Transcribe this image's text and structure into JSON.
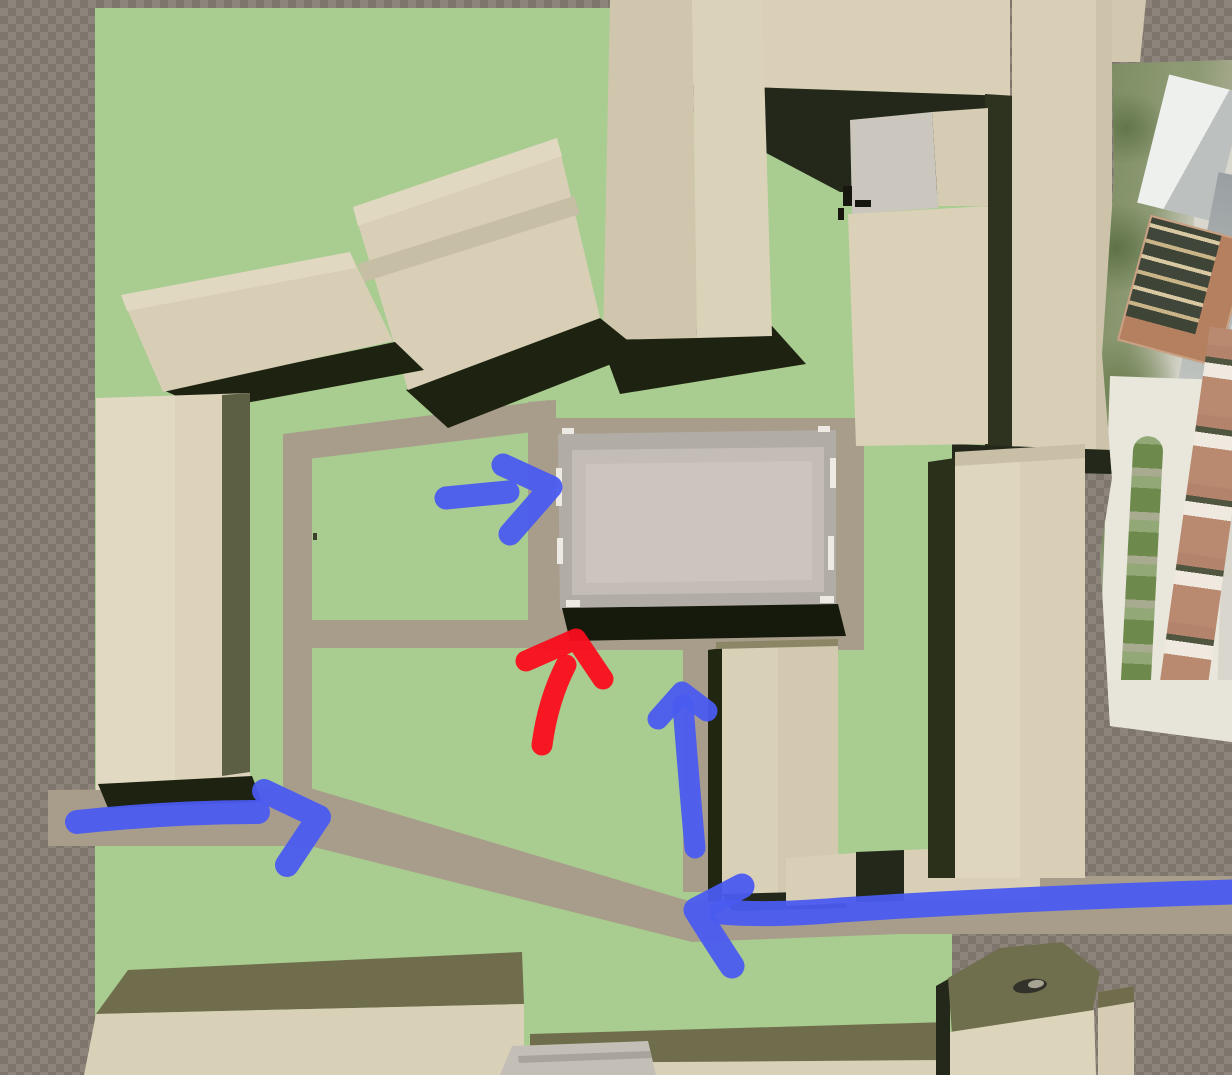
{
  "viewport": {
    "width": 1232,
    "height": 1075,
    "kind": "3d-site-model-top-down-view"
  },
  "palette": {
    "ground_green": "#a9cc90",
    "path_tan": "#a89d8b",
    "building_cream": "#dbd2b9",
    "building_roof_olive": "#6f6d4c",
    "shadow_dark": "#1d2310",
    "central_building_gray": "#c9c3bb",
    "annotation_blue": "#4a5bf0",
    "annotation_red": "#fa0d1d",
    "checker_light": "#8d847b",
    "checker_dark": "#7e756d"
  },
  "scene": {
    "shapes": [
      {
        "type": "polygon",
        "name": "ground-green-lawn",
        "attrs": {
          "points": "95,8 612,8 612,88 990,88 990,448 952,448 952,1040 690,1040 690,1075 95,1075",
          "fill": "#a9cc90"
        }
      },
      {
        "type": "polygon",
        "name": "path-loop-top",
        "attrs": {
          "points": "283,434 550,400 550,430 283,462",
          "fill": "#a89d8b"
        }
      },
      {
        "type": "polygon",
        "name": "path-loop-left",
        "attrs": {
          "points": "283,434 312,434 312,812 283,812",
          "fill": "#a89d8b"
        }
      },
      {
        "type": "polygon",
        "name": "path-loop-right",
        "attrs": {
          "points": "528,402 556,400 556,625 528,625",
          "fill": "#a89d8b"
        }
      },
      {
        "type": "polygon",
        "name": "path-courtyard-middle",
        "attrs": {
          "points": "295,620 558,620 558,648 295,648",
          "fill": "#a89d8b"
        }
      },
      {
        "type": "polygon",
        "name": "path-plaza-pad",
        "attrs": {
          "points": "546,418 864,418 864,650 546,650",
          "fill": "#a89d8b"
        }
      },
      {
        "type": "polygon",
        "name": "path-vertical-south",
        "attrs": {
          "points": "683,645 713,645 713,892 683,892",
          "fill": "#a89d8b"
        }
      },
      {
        "type": "polygon",
        "name": "path-diagonal-west",
        "attrs": {
          "points": "48,790 310,788 692,902 692,942 310,846 48,846",
          "fill": "#a89d8b"
        }
      },
      {
        "type": "polygon",
        "name": "path-east-road",
        "attrs": {
          "points": "692,902 900,876 1232,876 1232,934 900,934 692,942",
          "fill": "#a89d8b"
        }
      },
      {
        "type": "polygon",
        "name": "building-north-block",
        "attrs": {
          "points": "648,0 1010,0 1010,96 660,84",
          "fill": "#d9d0b7"
        }
      },
      {
        "type": "polygon",
        "name": "building-north-block-shadow",
        "attrs": {
          "points": "660,84 1010,96 1016,196 840,192 700,118",
          "fill": "#23281a"
        }
      },
      {
        "type": "polygon",
        "name": "shadow-strip-northeast",
        "attrs": {
          "points": "985,94 1016,96 1016,450 985,450",
          "fill": "#2e3320"
        }
      },
      {
        "type": "polygon",
        "name": "building-northeast-tower",
        "attrs": {
          "points": "1012,0 1112,0 1112,450 1012,450",
          "fill": "#d8cfb6"
        }
      },
      {
        "type": "polygon",
        "name": "building-northeast-tower-edge",
        "attrs": {
          "points": "1096,0 1112,0 1112,450 1096,450",
          "fill": "#ccc3aa"
        }
      },
      {
        "type": "polygon",
        "name": "building-northeast-roof-bit",
        "attrs": {
          "points": "1112,0 1146,0 1140,62 1112,62",
          "fill": "#d1c8af"
        }
      },
      {
        "type": "polygon",
        "name": "shadow-under-northeast-tower",
        "attrs": {
          "points": "952,444 1112,450 1112,474 952,470",
          "fill": "#23281a"
        }
      },
      {
        "type": "polygon",
        "name": "building-east-mid-gray-patch",
        "attrs": {
          "points": "850,120 932,112 938,208 852,214",
          "fill": "#cbc7bf"
        }
      },
      {
        "type": "polygon",
        "name": "building-east-mid-upper",
        "attrs": {
          "points": "932,112 988,108 988,206 938,206",
          "fill": "#d5ccb3"
        }
      },
      {
        "type": "polygon",
        "name": "building-east-mid",
        "attrs": {
          "points": "848,214 988,206 988,444 856,446",
          "fill": "#dad1b8"
        }
      },
      {
        "type": "rect",
        "name": "rooftop-detail-1",
        "attrs": {
          "x": 843,
          "y": 186,
          "width": 9,
          "height": 20,
          "fill": "#17170f"
        }
      },
      {
        "type": "rect",
        "name": "rooftop-detail-2",
        "attrs": {
          "x": 855,
          "y": 200,
          "width": 16,
          "height": 7,
          "fill": "#17170f"
        }
      },
      {
        "type": "rect",
        "name": "rooftop-detail-3",
        "attrs": {
          "x": 838,
          "y": 208,
          "width": 6,
          "height": 12,
          "fill": "#17170f"
        }
      },
      {
        "type": "polygon",
        "name": "building-top-center-shadow",
        "attrs": {
          "points": "598,334 772,326 806,364 620,394",
          "fill": "#1d2310"
        }
      },
      {
        "type": "polygon",
        "name": "building-top-center-left-face",
        "attrs": {
          "points": "610,0 692,0 697,338 603,340",
          "fill": "#cfc6ad"
        }
      },
      {
        "type": "polygon",
        "name": "building-top-center-right-face",
        "attrs": {
          "points": "692,0 762,0 772,336 697,338",
          "fill": "#dbd2ba"
        }
      },
      {
        "type": "polygon",
        "name": "building-gable-shadow",
        "attrs": {
          "points": "406,390 600,318 642,352 448,428",
          "fill": "#1d2310"
        }
      },
      {
        "type": "polygon",
        "name": "building-gable",
        "attrs": {
          "points": "353,207 557,138 600,318 408,390",
          "fill": "#d8cfb6"
        }
      },
      {
        "type": "polygon",
        "name": "building-gable-top-band",
        "attrs": {
          "points": "353,207 557,138 562,156 358,226",
          "fill": "#e0d8c1"
        }
      },
      {
        "type": "polygon",
        "name": "building-gable-ridge",
        "attrs": {
          "points": "358,264 574,196 580,214 364,282",
          "fill": "#c7bea6"
        }
      },
      {
        "type": "polygon",
        "name": "building-northwest-shadow",
        "attrs": {
          "points": "163,390 395,342 424,370 208,410",
          "fill": "#1d2310"
        }
      },
      {
        "type": "polygon",
        "name": "building-northwest",
        "attrs": {
          "points": "121,295 350,252 393,341 163,392",
          "fill": "#d7ceb5"
        }
      },
      {
        "type": "polygon",
        "name": "building-northwest-top-band",
        "attrs": {
          "points": "121,295 350,252 356,268 127,311",
          "fill": "#e0d8c1"
        }
      },
      {
        "type": "polygon",
        "name": "building-west-tower",
        "attrs": {
          "points": "96,398 250,393 250,788 96,790",
          "fill": "#dcd3ba"
        }
      },
      {
        "type": "polygon",
        "name": "building-west-tower-left-face",
        "attrs": {
          "points": "96,398 175,396 175,789 96,790",
          "fill": "#e1d9c2"
        }
      },
      {
        "type": "polygon",
        "name": "building-west-tower-olive-band",
        "attrs": {
          "points": "222,395 250,393 250,772 222,776",
          "fill": "#5d5f44"
        }
      },
      {
        "type": "polygon",
        "name": "building-west-tower-shadow",
        "attrs": {
          "points": "98,784 252,776 262,802 108,808",
          "fill": "#1d2310"
        }
      },
      {
        "type": "polygon",
        "name": "central-building-outer",
        "attrs": {
          "points": "558,434 836,430 836,606 560,610",
          "fill": "#b2aca6"
        }
      },
      {
        "type": "polygon",
        "name": "central-building-mid",
        "attrs": {
          "points": "572,450 824,447 824,592 572,595",
          "fill": "#c3bdb6"
        }
      },
      {
        "type": "polygon",
        "name": "central-building-inner",
        "attrs": {
          "points": "586,464 812,461 812,580 586,583",
          "fill": "#cbc5bd"
        }
      },
      {
        "type": "rect",
        "name": "central-building-highlight-1",
        "attrs": {
          "x": 556,
          "y": 468,
          "width": 6,
          "height": 38,
          "fill": "#edeae4"
        }
      },
      {
        "type": "rect",
        "name": "central-building-highlight-2",
        "attrs": {
          "x": 557,
          "y": 538,
          "width": 6,
          "height": 26,
          "fill": "#edeae4"
        }
      },
      {
        "type": "rect",
        "name": "central-building-highlight-3",
        "attrs": {
          "x": 830,
          "y": 458,
          "width": 6,
          "height": 30,
          "fill": "#edeae4"
        }
      },
      {
        "type": "rect",
        "name": "central-building-highlight-4",
        "attrs": {
          "x": 828,
          "y": 536,
          "width": 6,
          "height": 34,
          "fill": "#edeae4"
        }
      },
      {
        "type": "rect",
        "name": "central-building-highlight-5",
        "attrs": {
          "x": 566,
          "y": 600,
          "width": 14,
          "height": 7,
          "fill": "#edeae4"
        }
      },
      {
        "type": "rect",
        "name": "central-building-highlight-6",
        "attrs": {
          "x": 820,
          "y": 596,
          "width": 14,
          "height": 7,
          "fill": "#edeae4"
        }
      },
      {
        "type": "rect",
        "name": "central-building-highlight-7",
        "attrs": {
          "x": 562,
          "y": 428,
          "width": 12,
          "height": 6,
          "fill": "#edeae4"
        }
      },
      {
        "type": "rect",
        "name": "central-building-highlight-8",
        "attrs": {
          "x": 818,
          "y": 426,
          "width": 12,
          "height": 6,
          "fill": "#edeae4"
        }
      },
      {
        "type": "polygon",
        "name": "central-building-shadow",
        "attrs": {
          "points": "562,608 838,604 846,636 570,641",
          "fill": "#151a0c"
        }
      },
      {
        "type": "polygon",
        "name": "building-south-mid-left-shadow",
        "attrs": {
          "points": "708,650 722,648 722,900 708,902",
          "fill": "#20260f"
        }
      },
      {
        "type": "polygon",
        "name": "building-south-mid",
        "attrs": {
          "points": "722,648 838,644 838,894 722,897",
          "fill": "#d9d0b8"
        }
      },
      {
        "type": "polygon",
        "name": "building-south-mid-right-face",
        "attrs": {
          "points": "778,646 838,644 838,894 778,896",
          "fill": "#d2c9b0"
        }
      },
      {
        "type": "polygon",
        "name": "building-south-mid-top-edge",
        "attrs": {
          "points": "716,642 838,639 838,646 716,649",
          "fill": "#8a8666"
        }
      },
      {
        "type": "polygon",
        "name": "building-south-mid-bottom-shadow",
        "attrs": {
          "points": "722,894 838,891 848,908 732,911",
          "fill": "#23281a"
        }
      },
      {
        "type": "polygon",
        "name": "wall-east-a",
        "attrs": {
          "points": "786,858 868,852 868,902 786,906",
          "fill": "#d8cfb6"
        }
      },
      {
        "type": "polygon",
        "name": "wall-east-gap-shadow",
        "attrs": {
          "points": "856,852 904,850 904,901 856,902",
          "fill": "#23281a"
        }
      },
      {
        "type": "polygon",
        "name": "wall-east-b",
        "attrs": {
          "points": "904,850 1040,845 1040,899 904,901",
          "fill": "#d8cfb6"
        }
      },
      {
        "type": "polygon",
        "name": "building-east-tower-shadow",
        "attrs": {
          "points": "928,462 955,458 955,878 928,878",
          "fill": "#2b301b"
        }
      },
      {
        "type": "polygon",
        "name": "building-east-tower",
        "attrs": {
          "points": "955,458 1085,450 1085,878 955,878",
          "fill": "#d8cfb6"
        }
      },
      {
        "type": "polygon",
        "name": "building-east-tower-left-face",
        "attrs": {
          "points": "955,458 1020,454 1020,878 955,878",
          "fill": "#ded6be"
        }
      },
      {
        "type": "polygon",
        "name": "building-east-tower-top-band",
        "attrs": {
          "points": "955,452 1085,444 1085,458 955,466",
          "fill": "#c8bfa6"
        }
      },
      {
        "type": "polygon",
        "name": "building-south-long-roof",
        "attrs": {
          "points": "128,970 522,952 524,1004 96,1014",
          "fill": "#6f6d4c"
        }
      },
      {
        "type": "polygon",
        "name": "building-south-long-face",
        "attrs": {
          "points": "96,1014 524,1004 524,1075 84,1075",
          "fill": "#d9d0b8"
        }
      },
      {
        "type": "polygon",
        "name": "building-south-long2-roof",
        "attrs": {
          "points": "530,1034 948,1022 948,1060 530,1063",
          "fill": "#6f6d4c"
        }
      },
      {
        "type": "polygon",
        "name": "building-south-long2-face",
        "attrs": {
          "points": "530,1063 948,1060 948,1075 530,1075",
          "fill": "#d9d0b8"
        }
      },
      {
        "type": "polygon",
        "name": "gray-hip-roof",
        "attrs": {
          "points": "512,1046 648,1041 656,1075 500,1075",
          "fill": "#c3bfb7"
        }
      },
      {
        "type": "polygon",
        "name": "gray-hip-roof-ridge",
        "attrs": {
          "points": "518,1056 650,1051 652,1058 519,1063",
          "fill": "#a8a49c"
        }
      },
      {
        "type": "polygon",
        "name": "building-pentagon-left-shadow",
        "attrs": {
          "points": "936,986 950,978 950,1075 936,1075",
          "fill": "#23281a"
        }
      },
      {
        "type": "polygon",
        "name": "building-pentagon-roof",
        "attrs": {
          "points": "948,978 1000,948 1062,942 1100,972 1092,1014 1008,1044 952,1034",
          "fill": "#6f6e4d"
        }
      },
      {
        "type": "polygon",
        "name": "building-pentagon-face",
        "attrs": {
          "points": "950,1032 1094,1010 1096,1075 950,1075",
          "fill": "#ddd4bc"
        }
      },
      {
        "type": "ellipse",
        "name": "pentagon-roof-opening",
        "attrs": {
          "cx": 1030,
          "cy": 986,
          "rx": 17,
          "ry": 7,
          "fill": "#32322a",
          "transform": "rotate(-8 1030 986)"
        }
      },
      {
        "type": "ellipse",
        "name": "pentagon-roof-opening-light",
        "attrs": {
          "cx": 1036,
          "cy": 984,
          "rx": 8,
          "ry": 4,
          "fill": "#a8a494",
          "transform": "rotate(-8 1036 984)"
        }
      },
      {
        "type": "polygon",
        "name": "building-southeast-column",
        "attrs": {
          "points": "1098,992 1134,986 1134,1075 1098,1075",
          "fill": "#d5ccb3"
        }
      },
      {
        "type": "polygon",
        "name": "building-southeast-column-roof",
        "attrs": {
          "points": "1098,992 1134,986 1134,1002 1098,1008",
          "fill": "#6f6d4c"
        }
      },
      {
        "type": "rect",
        "name": "lawn-speck",
        "attrs": {
          "x": 313,
          "y": 533,
          "width": 4,
          "height": 7,
          "fill": "#3c3f2c"
        }
      }
    ]
  },
  "annotations": {
    "arrows": [
      {
        "name": "arrow-west-entrance",
        "direction": "right",
        "color": "#4a5bf0",
        "width": 24,
        "shaft": "M77,822 Q170,812 258,812",
        "head": "M264,791 L319,817 L287,865"
      },
      {
        "name": "arrow-plaza-west",
        "direction": "right",
        "color": "#4a5bf0",
        "width": 23,
        "shaft": "M446,498 L508,492",
        "head": "M503,465 L551,487 L510,534"
      },
      {
        "name": "arrow-plaza-south",
        "direction": "up",
        "color": "#fa0d1d",
        "width": 21,
        "shaft": "M542,745 Q548,700 566,665",
        "head": "M526,661 L576,639 L603,679"
      },
      {
        "name": "arrow-path-north",
        "direction": "up",
        "color": "#4a5bf0",
        "width": 21,
        "shaft": "M695,848 Q688,770 683,705",
        "head": "M658,719 L682,692 L707,711"
      },
      {
        "name": "arrow-east-road",
        "direction": "left",
        "color": "#4a5bf0",
        "width": 25,
        "shaft": "M1232,892 C1100,896 960,902 840,910 Q770,916 722,912",
        "head": "M742,886 L696,910 Q716,942 732,966"
      }
    ]
  }
}
